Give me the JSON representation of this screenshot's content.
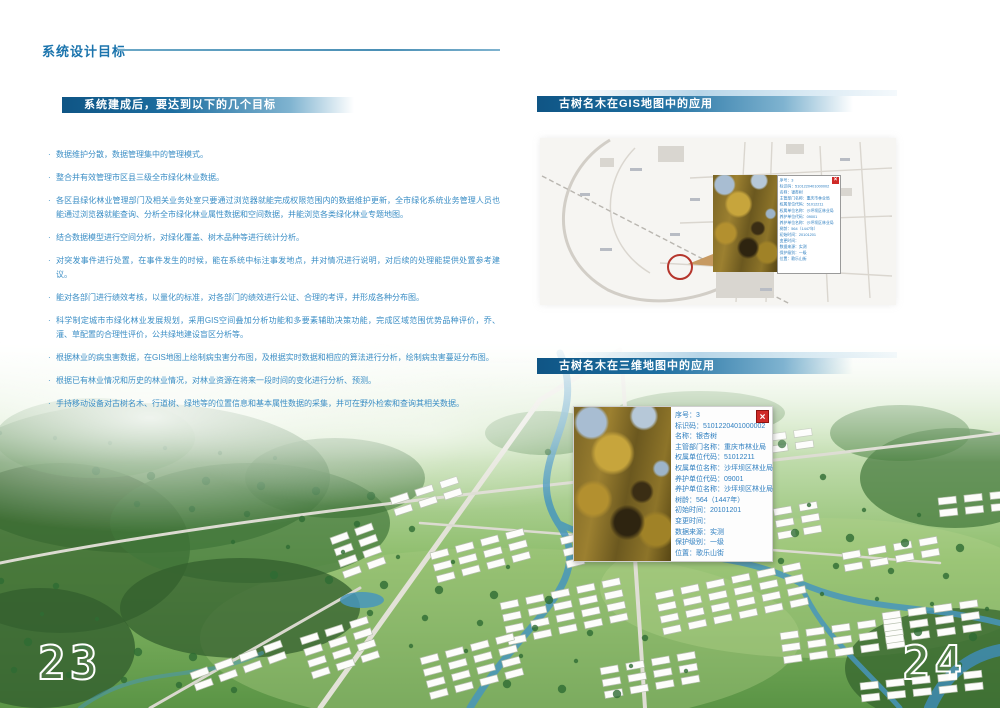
{
  "header": {
    "title": "系统设计目标"
  },
  "left": {
    "section_title": "系统建成后，要达到以下的几个目标",
    "bullets": [
      "数据维护分散，数据管理集中的管理模式。",
      "整合并有效管理市区县三级全市绿化林业数据。",
      "各区县绿化林业管理部门及相关业务处室只要通过浏览器就能完成权限范围内的数据维护更新，全市绿化系统业务管理人员也能通过浏览器就能查询、分析全市绿化林业属性数据和空间数据，并能浏览各类绿化林业专题地图。",
      "结合数据模型进行空间分析，对绿化覆盖、树木品种等进行统计分析。",
      "对突发事件进行处置，在事件发生的时候，能在系统中标注事发地点，并对情况进行说明，对后续的处理能提供处置参考建议。",
      "能对各部门进行绩效考核，以量化的标准，对各部门的绩效进行公证、合理的考评，并形成各种分布图。",
      "科学制定城市市绿化林业发展规划，采用GIS空间叠加分析功能和多要素辅助决策功能，完成区域范围优势品种评价，乔、灌、草配置的合理性评价，公共绿地建设盲区分析等。",
      "根据林业的病虫害数据，在GIS地图上绘制病虫害分布图，及根据实时数据和相应的算法进行分析，绘制病虫害蔓延分布图。",
      "根据已有林业情况和历史的林业情况，对林业资源在将来一段时间的变化进行分析、预测。",
      "手持移动设备对古树名木、行道树、绿地等的位置信息和基本属性数据的采集，并可在野外检索和查询其相关数据。"
    ]
  },
  "right": {
    "gis_section_title": "古树名木在GIS地图中的应用",
    "three_d_section_title": "古树名木在三维地图中的应用",
    "popup_close_label": "×",
    "tree_info": {
      "fields": [
        {
          "label": "序号",
          "value": "3"
        },
        {
          "label": "标识码",
          "value": "5101220401000002"
        },
        {
          "label": "名称",
          "value": "银杏树"
        },
        {
          "label": "主管部门名称",
          "value": "重庆市林业局"
        },
        {
          "label": "权属单位代码",
          "value": "51012211"
        },
        {
          "label": "权属单位名称",
          "value": "沙坪坝区林业局"
        },
        {
          "label": "养护单位代码",
          "value": "09001"
        },
        {
          "label": "养护单位名称",
          "value": "沙坪坝区林业局"
        },
        {
          "label": "树龄",
          "value": "564（1447年）"
        },
        {
          "label": "初始时间",
          "value": "20101201"
        },
        {
          "label": "变更时间",
          "value": ""
        },
        {
          "label": "数据来源",
          "value": "实测"
        },
        {
          "label": "保护级别",
          "value": "一级"
        },
        {
          "label": "位置",
          "value": "歌乐山街"
        }
      ]
    }
  },
  "page_numbers": {
    "left": "23",
    "right": "24"
  },
  "colors": {
    "accent_blue": "#1b74ad",
    "bullet_blue": "#3b8ec5",
    "bar_dark": "#0f5585",
    "close_red": "#cf2a27",
    "marker_red": "#b5352c"
  }
}
